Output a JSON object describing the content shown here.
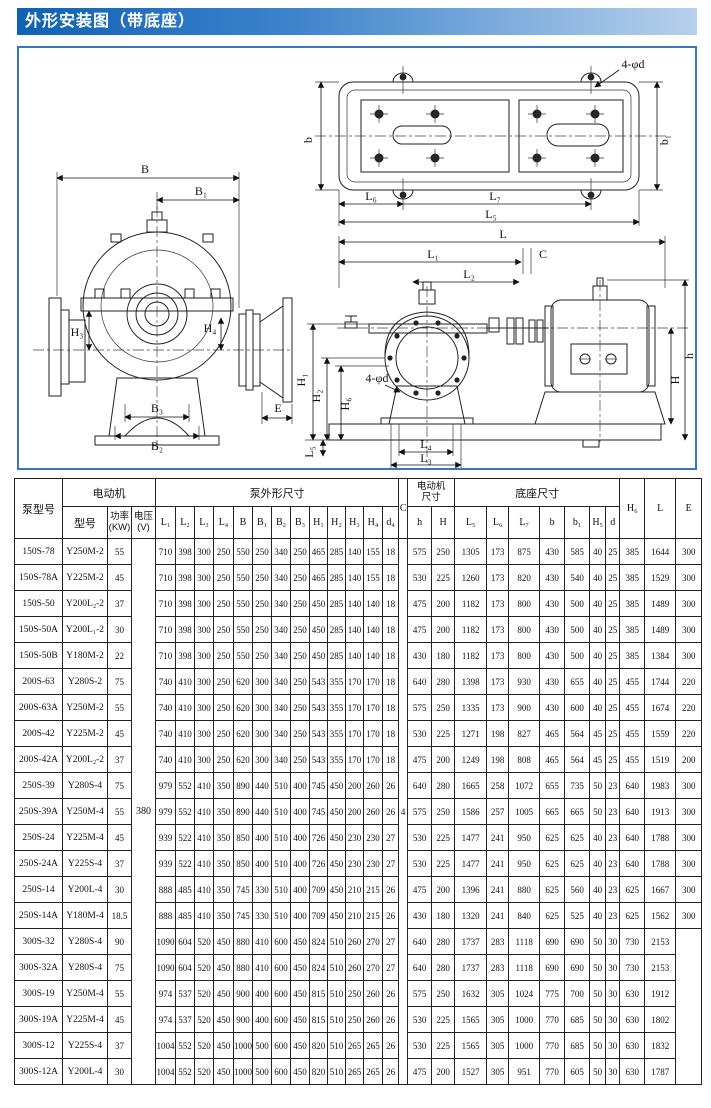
{
  "title": "外形安装图（带底座）",
  "drawings": {
    "front": {
      "B": "B",
      "B1": "B₁",
      "H3": "H₃",
      "H4": "H₄",
      "B3": "B₃",
      "B2": "B₂",
      "E": "E"
    },
    "plan": {
      "bolt": "4-φd",
      "b": "b",
      "b1": "b₁",
      "L6": "L₆",
      "L7": "L₇",
      "L5": "L₅"
    },
    "assembly": {
      "L": "L",
      "L1": "L₁",
      "L2": "L₂",
      "C": "C",
      "h": "h",
      "H": "H",
      "H1": "H₁",
      "H2": "H₂",
      "H6": "H₆",
      "bolt": "4-φd",
      "L5": "L₅",
      "L4": "L₄",
      "L3": "L₃"
    }
  },
  "table": {
    "headers": {
      "pump_model": "泵型号",
      "motor_group": "电动机",
      "motor_model": "型号",
      "power": "功率\n(KW)",
      "voltage": "电压\n(V)",
      "pump_dims_group": "泵外形尺寸",
      "dims": [
        "L₁",
        "L₂",
        "L₃",
        "L₄",
        "B",
        "B₁",
        "B₂",
        "B₃",
        "H₁",
        "H₂",
        "H₃",
        "H₄",
        "d₄"
      ],
      "c": "C",
      "motor_dims_group": "电动机\n尺寸",
      "motor_dims": [
        "h",
        "H"
      ],
      "base_dims_group": "底座尺寸",
      "base_dims": [
        "L₅",
        "L₆",
        "L₇",
        "b",
        "b₁",
        "H₅",
        "d"
      ],
      "h6": "H₆",
      "l": "L",
      "e": "E"
    },
    "voltage_value": "380",
    "c_value": "4",
    "rows": [
      {
        "model": "150S-78",
        "motor": "Y250M-2",
        "power": "55",
        "dims": [
          "710",
          "398",
          "300",
          "250",
          "550",
          "250",
          "340",
          "250",
          "465",
          "285",
          "140",
          "155",
          "18"
        ],
        "md": [
          "575",
          "250"
        ],
        "bd": [
          "1305",
          "173",
          "875",
          "430",
          "585",
          "40",
          "25"
        ],
        "H6": "385",
        "L": "1644",
        "E": "300"
      },
      {
        "model": "150S-78A",
        "motor": "Y225M-2",
        "power": "45",
        "dims": [
          "710",
          "398",
          "300",
          "250",
          "550",
          "250",
          "340",
          "250",
          "465",
          "285",
          "140",
          "155",
          "18"
        ],
        "md": [
          "530",
          "225"
        ],
        "bd": [
          "1260",
          "173",
          "820",
          "430",
          "540",
          "40",
          "25"
        ],
        "H6": "385",
        "L": "1529",
        "E": "300"
      },
      {
        "model": "150S-50",
        "motor": "Y200L₂-2",
        "power": "37",
        "dims": [
          "710",
          "398",
          "300",
          "250",
          "550",
          "250",
          "340",
          "250",
          "450",
          "285",
          "140",
          "140",
          "18"
        ],
        "md": [
          "475",
          "200"
        ],
        "bd": [
          "1182",
          "173",
          "800",
          "430",
          "500",
          "40",
          "25"
        ],
        "H6": "385",
        "L": "1489",
        "E": "300"
      },
      {
        "model": "150S-50A",
        "motor": "Y200L₁-2",
        "power": "30",
        "dims": [
          "710",
          "398",
          "300",
          "250",
          "550",
          "250",
          "340",
          "250",
          "450",
          "285",
          "140",
          "140",
          "18"
        ],
        "md": [
          "475",
          "200"
        ],
        "bd": [
          "1182",
          "173",
          "800",
          "430",
          "500",
          "40",
          "25"
        ],
        "H6": "385",
        "L": "1489",
        "E": "300"
      },
      {
        "model": "150S-50B",
        "motor": "Y180M-2",
        "power": "22",
        "dims": [
          "710",
          "398",
          "300",
          "250",
          "550",
          "250",
          "340",
          "250",
          "450",
          "285",
          "140",
          "140",
          "18"
        ],
        "md": [
          "430",
          "180"
        ],
        "bd": [
          "1182",
          "173",
          "800",
          "430",
          "500",
          "40",
          "25"
        ],
        "H6": "385",
        "L": "1384",
        "E": "300"
      },
      {
        "model": "200S-63",
        "motor": "Y280S-2",
        "power": "75",
        "dims": [
          "740",
          "410",
          "300",
          "250",
          "620",
          "300",
          "340",
          "250",
          "543",
          "355",
          "170",
          "170",
          "18"
        ],
        "md": [
          "640",
          "280"
        ],
        "bd": [
          "1398",
          "173",
          "930",
          "430",
          "655",
          "40",
          "25"
        ],
        "H6": "455",
        "L": "1744",
        "E": "220"
      },
      {
        "model": "200S-63A",
        "motor": "Y250M-2",
        "power": "55",
        "dims": [
          "740",
          "410",
          "300",
          "250",
          "620",
          "300",
          "340",
          "250",
          "543",
          "355",
          "170",
          "170",
          "18"
        ],
        "md": [
          "575",
          "250"
        ],
        "bd": [
          "1335",
          "173",
          "900",
          "430",
          "600",
          "40",
          "25"
        ],
        "H6": "455",
        "L": "1674",
        "E": "220"
      },
      {
        "model": "200S-42",
        "motor": "Y225M-2",
        "power": "45",
        "dims": [
          "740",
          "410",
          "300",
          "250",
          "620",
          "300",
          "340",
          "250",
          "543",
          "355",
          "170",
          "170",
          "18"
        ],
        "md": [
          "530",
          "225"
        ],
        "bd": [
          "1271",
          "198",
          "827",
          "465",
          "564",
          "45",
          "25"
        ],
        "H6": "455",
        "L": "1559",
        "E": "220"
      },
      {
        "model": "200S-42A",
        "motor": "Y200L₂-2",
        "power": "37",
        "dims": [
          "740",
          "410",
          "300",
          "250",
          "620",
          "300",
          "340",
          "250",
          "543",
          "355",
          "170",
          "170",
          "18"
        ],
        "md": [
          "475",
          "200"
        ],
        "bd": [
          "1249",
          "198",
          "808",
          "465",
          "564",
          "45",
          "25"
        ],
        "H6": "455",
        "L": "1519",
        "E": "200"
      },
      {
        "model": "250S-39",
        "motor": "Y280S-4",
        "power": "75",
        "dims": [
          "979",
          "552",
          "410",
          "350",
          "890",
          "440",
          "510",
          "400",
          "745",
          "450",
          "200",
          "260",
          "26"
        ],
        "md": [
          "640",
          "280"
        ],
        "bd": [
          "1665",
          "258",
          "1072",
          "655",
          "735",
          "50",
          "23"
        ],
        "H6": "640",
        "L": "1983",
        "E": "300"
      },
      {
        "model": "250S-39A",
        "motor": "Y250M-4",
        "power": "55",
        "dims": [
          "979",
          "552",
          "410",
          "350",
          "890",
          "440",
          "510",
          "400",
          "745",
          "450",
          "200",
          "260",
          "26"
        ],
        "md": [
          "575",
          "250"
        ],
        "bd": [
          "1586",
          "257",
          "1005",
          "665",
          "665",
          "50",
          "23"
        ],
        "H6": "640",
        "L": "1913",
        "E": "300"
      },
      {
        "model": "250S-24",
        "motor": "Y225M-4",
        "power": "45",
        "dims": [
          "939",
          "522",
          "410",
          "350",
          "850",
          "400",
          "510",
          "400",
          "726",
          "450",
          "230",
          "230",
          "27"
        ],
        "md": [
          "530",
          "225"
        ],
        "bd": [
          "1477",
          "241",
          "950",
          "625",
          "625",
          "40",
          "23"
        ],
        "H6": "640",
        "L": "1788",
        "E": "300"
      },
      {
        "model": "250S-24A",
        "motor": "Y225S-4",
        "power": "37",
        "dims": [
          "939",
          "522",
          "410",
          "350",
          "850",
          "400",
          "510",
          "400",
          "726",
          "450",
          "230",
          "230",
          "27"
        ],
        "md": [
          "530",
          "225"
        ],
        "bd": [
          "1477",
          "241",
          "950",
          "625",
          "625",
          "40",
          "23"
        ],
        "H6": "640",
        "L": "1788",
        "E": "300"
      },
      {
        "model": "250S-14",
        "motor": "Y200L-4",
        "power": "30",
        "dims": [
          "888",
          "485",
          "410",
          "350",
          "745",
          "330",
          "510",
          "400",
          "709",
          "450",
          "210",
          "215",
          "26"
        ],
        "md": [
          "475",
          "200"
        ],
        "bd": [
          "1396",
          "241",
          "880",
          "625",
          "560",
          "40",
          "23"
        ],
        "H6": "625",
        "L": "1667",
        "E": "300"
      },
      {
        "model": "250S-14A",
        "motor": "Y180M-4",
        "power": "18.5",
        "dims": [
          "888",
          "485",
          "410",
          "350",
          "745",
          "330",
          "510",
          "400",
          "709",
          "450",
          "210",
          "215",
          "26"
        ],
        "md": [
          "430",
          "180"
        ],
        "bd": [
          "1320",
          "241",
          "840",
          "625",
          "525",
          "40",
          "23"
        ],
        "H6": "625",
        "L": "1562",
        "E": "300"
      },
      {
        "model": "300S-32",
        "motor": "Y280S-4",
        "power": "90",
        "dims": [
          "1090",
          "604",
          "520",
          "450",
          "880",
          "410",
          "600",
          "450",
          "824",
          "510",
          "260",
          "270",
          "27"
        ],
        "md": [
          "640",
          "280"
        ],
        "bd": [
          "1737",
          "283",
          "1118",
          "690",
          "690",
          "50",
          "30"
        ],
        "H6": "730",
        "L": "2153"
      },
      {
        "model": "300S-32A",
        "motor": "Y280S-4",
        "power": "75",
        "dims": [
          "1090",
          "604",
          "520",
          "450",
          "880",
          "410",
          "600",
          "450",
          "824",
          "510",
          "260",
          "270",
          "27"
        ],
        "md": [
          "640",
          "280"
        ],
        "bd": [
          "1737",
          "283",
          "1118",
          "690",
          "690",
          "50",
          "30"
        ],
        "H6": "730",
        "L": "2153"
      },
      {
        "model": "300S-19",
        "motor": "Y250M-4",
        "power": "55",
        "dims": [
          "974",
          "537",
          "520",
          "450",
          "900",
          "400",
          "600",
          "450",
          "815",
          "510",
          "250",
          "260",
          "26"
        ],
        "md": [
          "575",
          "250"
        ],
        "bd": [
          "1632",
          "305",
          "1024",
          "775",
          "700",
          "50",
          "30"
        ],
        "H6": "630",
        "L": "1912"
      },
      {
        "model": "300S-19A",
        "motor": "Y225M-4",
        "power": "45",
        "dims": [
          "974",
          "537",
          "520",
          "450",
          "900",
          "400",
          "600",
          "450",
          "815",
          "510",
          "250",
          "260",
          "26"
        ],
        "md": [
          "530",
          "225"
        ],
        "bd": [
          "1565",
          "305",
          "1000",
          "770",
          "685",
          "50",
          "30"
        ],
        "H6": "630",
        "L": "1802"
      },
      {
        "model": "300S-12",
        "motor": "Y225S-4",
        "power": "37",
        "dims": [
          "1004",
          "552",
          "520",
          "450",
          "1000",
          "500",
          "600",
          "450",
          "820",
          "510",
          "265",
          "265",
          "26"
        ],
        "md": [
          "530",
          "225"
        ],
        "bd": [
          "1565",
          "305",
          "1000",
          "770",
          "685",
          "50",
          "30"
        ],
        "H6": "630",
        "L": "1832"
      },
      {
        "model": "300S-12A",
        "motor": "Y200L-4",
        "power": "30",
        "dims": [
          "1004",
          "552",
          "520",
          "450",
          "1000",
          "500",
          "600",
          "450",
          "820",
          "510",
          "265",
          "265",
          "26"
        ],
        "md": [
          "475",
          "200"
        ],
        "bd": [
          "1527",
          "305",
          "951",
          "770",
          "605",
          "50",
          "30"
        ],
        "H6": "630",
        "L": "1787"
      }
    ]
  }
}
